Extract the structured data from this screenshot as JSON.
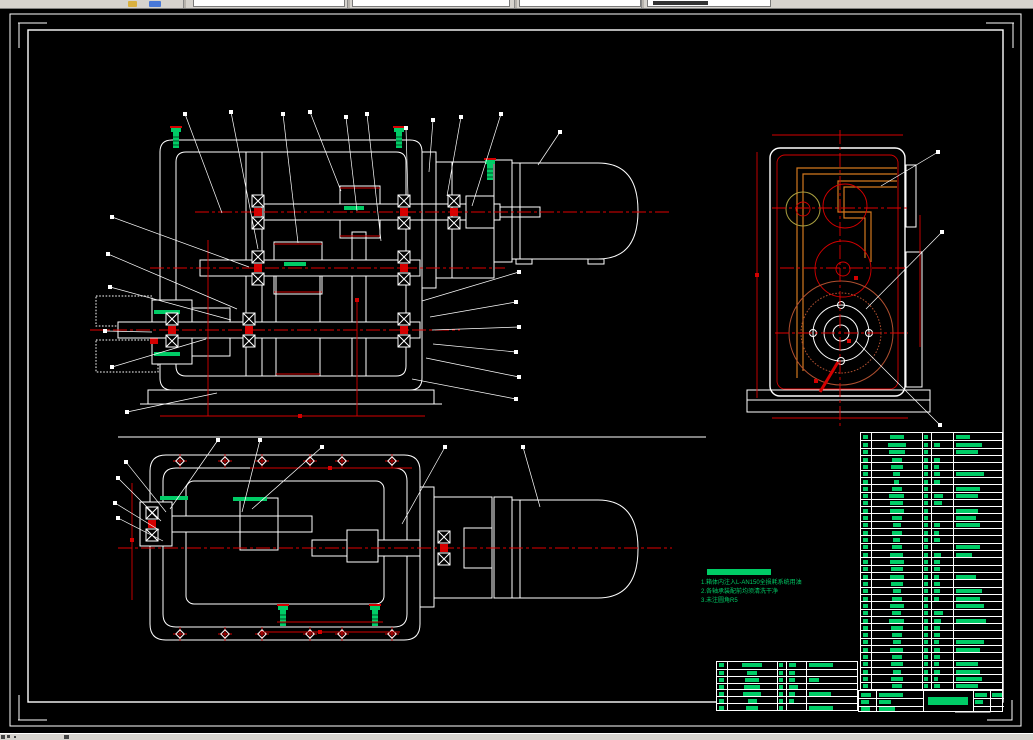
{
  "window": {
    "toolbar": {
      "note": "cad-toolbar-clipped"
    },
    "statusbar": {
      "note": "status-strip-clipped"
    }
  },
  "colors": {
    "background": "#000000",
    "drawing_line": "#ffffff",
    "centerline_red": "#e00000",
    "dimension_red": "#d40000",
    "annotation_green": "#00cc66",
    "hatch_fill_blue": "#000a78",
    "hatch_line_blue": "#4040ff",
    "oil_pipe_orange": "#d2781e",
    "gear_circle_brown": "#b05030",
    "chrome_gray": "#d6d3ce"
  },
  "notes": {
    "lines": [
      "1.箱体内注入L-AN150全损耗系统用油",
      "2.各轴承装配前均须清洗干净",
      "3.未注圆角R5"
    ]
  },
  "parts_table_rows": [
    [
      14,
      1,
      0,
      14
    ],
    [
      18,
      1,
      6,
      26
    ],
    [
      16,
      1,
      0,
      22
    ],
    [
      10,
      1,
      6,
      0
    ],
    [
      12,
      1,
      5,
      0
    ],
    [
      7,
      1,
      6,
      28
    ],
    [
      5,
      1,
      6,
      0
    ],
    [
      10,
      1,
      0,
      24
    ],
    [
      15,
      1,
      9,
      22
    ],
    [
      13,
      1,
      8,
      0
    ],
    [
      14,
      1,
      0,
      22
    ],
    [
      10,
      1,
      0,
      20
    ],
    [
      8,
      1,
      6,
      24
    ],
    [
      10,
      1,
      5,
      0
    ],
    [
      7,
      1,
      6,
      0
    ],
    [
      10,
      1,
      0,
      24
    ],
    [
      13,
      1,
      7,
      16
    ],
    [
      14,
      1,
      6,
      0
    ],
    [
      12,
      1,
      6,
      0
    ],
    [
      14,
      1,
      5,
      20
    ],
    [
      12,
      1,
      6,
      0
    ],
    [
      8,
      1,
      6,
      26
    ],
    [
      10,
      1,
      5,
      24
    ],
    [
      14,
      1,
      0,
      28
    ],
    [
      9,
      1,
      9,
      0
    ],
    [
      15,
      1,
      7,
      30
    ],
    [
      12,
      1,
      6,
      0
    ],
    [
      10,
      1,
      6,
      0
    ],
    [
      8,
      1,
      5,
      28
    ],
    [
      13,
      1,
      6,
      24
    ],
    [
      10,
      1,
      6,
      0
    ],
    [
      12,
      1,
      5,
      22
    ],
    [
      8,
      1,
      6,
      24
    ],
    [
      12,
      1,
      4,
      26
    ],
    [
      10,
      1,
      6,
      22
    ]
  ],
  "cont_table_rows": [
    [
      20,
      1,
      7,
      24
    ],
    [
      10,
      1,
      6,
      0
    ],
    [
      14,
      1,
      6,
      10
    ],
    [
      16,
      1,
      9,
      0
    ],
    [
      18,
      1,
      6,
      22
    ],
    [
      9,
      1,
      5,
      0
    ],
    [
      12,
      1,
      0,
      24
    ]
  ],
  "title_block": {
    "left_rows": [
      10,
      8,
      9
    ],
    "mid_rows": [
      24,
      12,
      16
    ],
    "title_width": 40,
    "right_col1": [
      12,
      8
    ],
    "right_col2": [
      10
    ]
  }
}
